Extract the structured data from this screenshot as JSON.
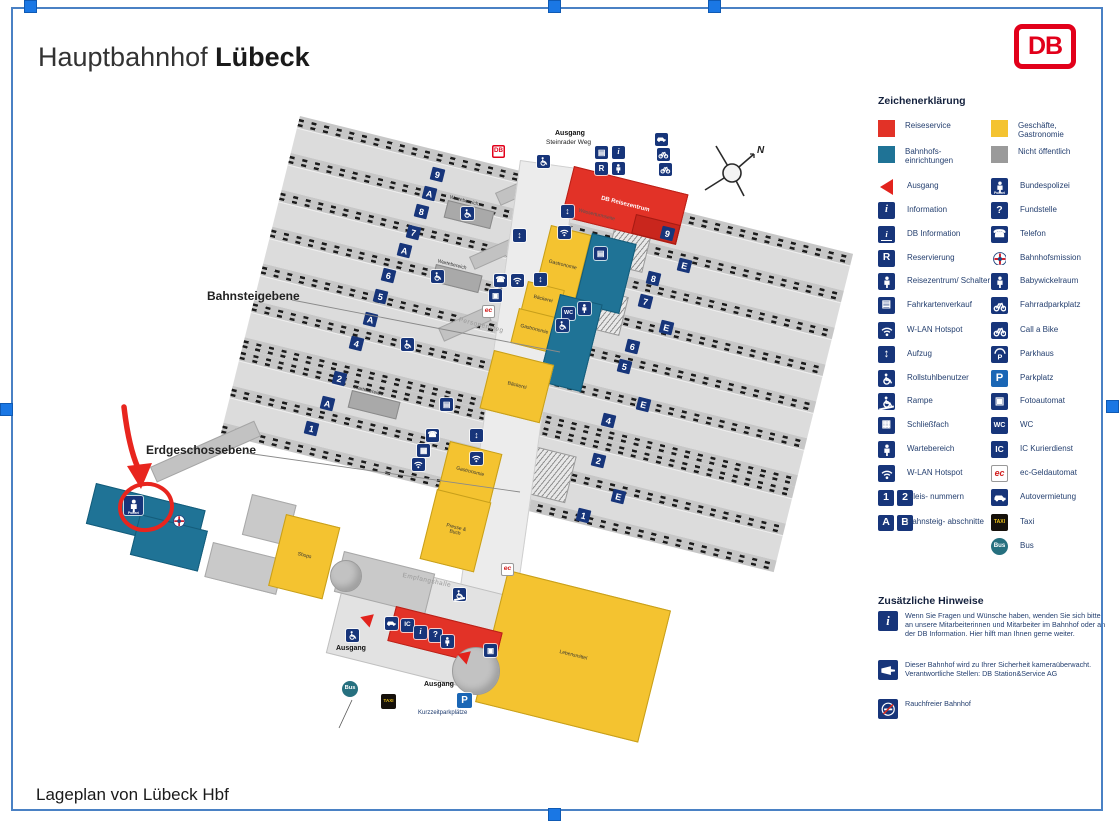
{
  "header": {
    "title_regular": "Hauptbahnhof",
    "title_bold": "Lübeck",
    "logo_text": "DB"
  },
  "footer": {
    "caption": "Lageplan von Lübeck Hbf"
  },
  "colors": {
    "reiseservice_red": "#e23227",
    "shops_yellow": "#f4c330",
    "einrichtungen_teal": "#1f7396",
    "nicht_oeffentlich_gray": "#9a9a9a",
    "picto_navy": "#17357a",
    "frame_blue": "#4a81c4",
    "handle_blue": "#1a77e4",
    "db_red": "#e2001a",
    "annotation_red": "#e8251e"
  },
  "legend": {
    "title": "Zeichenerklärung",
    "swatches": [
      {
        "name": "reiseservice",
        "color": "#e23227",
        "label": "Reiseservice"
      },
      {
        "name": "geschaefte-gastronomie",
        "color": "#f4c330",
        "label": "Geschäfte, Gastronomie"
      },
      {
        "name": "bahnhofseinrichtungen",
        "color": "#1f7396",
        "label": "Bahnhofs- einrichtungen"
      },
      {
        "name": "nicht-oeffentlich",
        "color": "#9a9a9a",
        "label": "Nicht öffentlich"
      }
    ],
    "rows": [
      {
        "left": {
          "icon": "ausgang",
          "label": "Ausgang"
        },
        "right": {
          "icon": "bundespolizei",
          "label": "Bundespolizei"
        }
      },
      {
        "left": {
          "icon": "information",
          "label": "Information"
        },
        "right": {
          "icon": "fundstelle",
          "label": "Fundstelle"
        }
      },
      {
        "left": {
          "icon": "db-information",
          "label": "DB Information"
        },
        "right": {
          "icon": "telefon",
          "label": "Telefon"
        }
      },
      {
        "left": {
          "icon": "reservierung",
          "label": "Reservierung"
        },
        "right": {
          "icon": "bahnhofsmission",
          "label": "Bahnhofsmission"
        }
      },
      {
        "left": {
          "icon": "schalter",
          "label": "Reisezentrum/ Schalter"
        },
        "right": {
          "icon": "babywickelraum",
          "label": "Babywickelraum"
        }
      },
      {
        "left": {
          "icon": "fahrkartenverkauf",
          "label": "Fahrkartenverkauf"
        },
        "right": {
          "icon": "fahrradparkplatz",
          "label": "Fahrradparkplatz"
        }
      },
      {
        "left": {
          "icon": "wlan",
          "label": "W-LAN Hotspot"
        },
        "right": {
          "icon": "call-a-bike",
          "label": "Call a Bike"
        }
      },
      {
        "left": {
          "icon": "aufzug",
          "label": "Aufzug"
        },
        "right": {
          "icon": "parkhaus",
          "label": "Parkhaus"
        }
      },
      {
        "left": {
          "icon": "rollstuhl",
          "label": "Rollstuhlbenutzer"
        },
        "right": {
          "icon": "parkplatz",
          "label": "Parkplatz"
        }
      },
      {
        "left": {
          "icon": "rampe",
          "label": "Rampe"
        },
        "right": {
          "icon": "fotoautomat",
          "label": "Fotoautomat"
        }
      },
      {
        "left": {
          "icon": "schliessfach",
          "label": "Schließfach"
        },
        "right": {
          "icon": "wc",
          "label": "WC"
        }
      },
      {
        "left": {
          "icon": "wartebereich",
          "label": "Wartebereich"
        },
        "right": {
          "icon": "ic",
          "label": "IC Kurierdienst"
        }
      },
      {
        "left": {
          "icon": "wlan",
          "label": "W-LAN Hotspot"
        },
        "right": {
          "icon": "ec",
          "label": "ec-Geldautomat"
        }
      },
      {
        "left": {
          "icon": "gleis-1-2",
          "label": "Gleis- nummern"
        },
        "right": {
          "icon": "autovermietung",
          "label": "Autovermietung"
        }
      },
      {
        "left": {
          "icon": "abschnitt-a-b",
          "label": "Bahnsteig- abschnitte"
        },
        "right": {
          "icon": "taxi",
          "label": "Taxi"
        }
      },
      {
        "left": null,
        "right": {
          "icon": "bus",
          "label": "Bus"
        }
      }
    ]
  },
  "notes": {
    "title": "Zusätzliche Hinweise",
    "items": [
      {
        "icon": "information",
        "text": "Wenn Sie Fragen und Wünsche haben, wenden Sie sich bitte an unsere Mitarbeiterinnen und Mitarbeiter im Bahnhof oder an der DB Information. Hier hilft man Ihnen gerne weiter."
      },
      {
        "icon": "kamera",
        "text": "Dieser Bahnhof wird zu Ihrer Sicherheit kameraüberwacht. Verantwortliche Stellen: DB Station&Service AG"
      },
      {
        "icon": "rauchfrei",
        "text": "Rauchfreier Bahnhof"
      }
    ]
  },
  "map": {
    "compass_label": "N",
    "shelter_label": "Wartebereich",
    "buildings": {
      "db_reisezentrum": "DB Reisezentrum",
      "gastronomie_top": "Gastronomie",
      "baeckerei_mid": "Bäckerei",
      "gastronomie_mid": "Gastronomie",
      "baeckerei_big": "Bäckerei",
      "gastronomie_low": "Gastronomie",
      "presse_buch": "Presse & Buch",
      "shops": "Shops",
      "lebensmittel": "Lebensmittel"
    },
    "texts": [
      {
        "id": "exit-top-line1",
        "t": "Ausgang",
        "x": 555,
        "y": 130,
        "k": "bold"
      },
      {
        "id": "exit-top-line2",
        "t": "Steinrader Weg",
        "x": 546,
        "y": 139,
        "k": "small"
      },
      {
        "id": "bridge-label",
        "t": "Wasserturmseite",
        "x": 578,
        "y": 212,
        "k": "tiny",
        "r": 14
      },
      {
        "id": "walkway-label",
        "t": "Personensteg",
        "x": 458,
        "y": 322,
        "k": "gray",
        "r": 14
      },
      {
        "id": "hall-label",
        "t": "Empfangshalle",
        "x": 402,
        "y": 577,
        "k": "gray",
        "r": 12
      },
      {
        "id": "exit-left-label",
        "t": "Ausgang",
        "x": 336,
        "y": 645,
        "k": "bold"
      },
      {
        "id": "exit-bottom-label",
        "t": "Ausgang",
        "x": 424,
        "y": 681,
        "k": "bold"
      },
      {
        "id": "parking-label",
        "t": "Kurzzeitparkplätze",
        "x": 418,
        "y": 710,
        "k": "navy"
      },
      {
        "id": "level-platform-label",
        "t": "Bahnsteigebene",
        "x": 207,
        "y": 289,
        "k": "level"
      },
      {
        "id": "level-ground-label",
        "t": "Erdgeschossebene",
        "x": 146,
        "y": 443,
        "k": "level"
      }
    ],
    "platform_badges": [
      {
        "t": "9",
        "x": 431,
        "y": 168
      },
      {
        "t": "A",
        "x": 423,
        "y": 187
      },
      {
        "t": "8",
        "x": 415,
        "y": 205
      },
      {
        "t": "7",
        "x": 407,
        "y": 226
      },
      {
        "t": "A",
        "x": 398,
        "y": 244
      },
      {
        "t": "6",
        "x": 382,
        "y": 269
      },
      {
        "t": "5",
        "x": 374,
        "y": 290
      },
      {
        "t": "A",
        "x": 364,
        "y": 313
      },
      {
        "t": "4",
        "x": 350,
        "y": 337
      },
      {
        "t": "2",
        "x": 333,
        "y": 372
      },
      {
        "t": "A",
        "x": 321,
        "y": 397
      },
      {
        "t": "1",
        "x": 305,
        "y": 422
      },
      {
        "t": "9",
        "x": 661,
        "y": 227
      },
      {
        "t": "E",
        "x": 678,
        "y": 259
      },
      {
        "t": "8",
        "x": 647,
        "y": 272
      },
      {
        "t": "7",
        "x": 639,
        "y": 295
      },
      {
        "t": "E",
        "x": 660,
        "y": 321
      },
      {
        "t": "6",
        "x": 626,
        "y": 340
      },
      {
        "t": "5",
        "x": 618,
        "y": 360
      },
      {
        "t": "E",
        "x": 637,
        "y": 398
      },
      {
        "t": "4",
        "x": 602,
        "y": 414
      },
      {
        "t": "2",
        "x": 592,
        "y": 454
      },
      {
        "t": "E",
        "x": 612,
        "y": 490
      },
      {
        "t": "1",
        "x": 577,
        "y": 509
      }
    ],
    "icons": [
      {
        "t": "autovermietung",
        "x": 655,
        "y": 133
      },
      {
        "t": "fahrradparkplatz",
        "x": 657,
        "y": 148
      },
      {
        "t": "call-a-bike",
        "x": 659,
        "y": 163
      },
      {
        "t": "fahrkartenverkauf",
        "x": 595,
        "y": 146
      },
      {
        "t": "information",
        "x": 612,
        "y": 146
      },
      {
        "t": "reservierung",
        "x": 595,
        "y": 162
      },
      {
        "t": "schalter",
        "x": 612,
        "y": 162
      },
      {
        "t": "rollstuhl",
        "x": 537,
        "y": 155
      },
      {
        "t": "db-mini",
        "x": 492,
        "y": 145
      },
      {
        "t": "aufzug",
        "x": 561,
        "y": 205
      },
      {
        "t": "wlan",
        "x": 558,
        "y": 226
      },
      {
        "t": "kiosk",
        "x": 594,
        "y": 247
      },
      {
        "t": "aufzug",
        "x": 534,
        "y": 273
      },
      {
        "t": "telefon",
        "x": 494,
        "y": 274
      },
      {
        "t": "wlan",
        "x": 511,
        "y": 274
      },
      {
        "t": "fotoautomat",
        "x": 489,
        "y": 289
      },
      {
        "t": "ec",
        "x": 482,
        "y": 305
      },
      {
        "t": "wc",
        "x": 562,
        "y": 307
      },
      {
        "t": "babywickelraum",
        "x": 578,
        "y": 302
      },
      {
        "t": "rollstuhl",
        "x": 556,
        "y": 319
      },
      {
        "t": "rollstuhl",
        "x": 461,
        "y": 207
      },
      {
        "t": "rollstuhl",
        "x": 431,
        "y": 270
      },
      {
        "t": "rollstuhl",
        "x": 401,
        "y": 338
      },
      {
        "t": "aufzug",
        "x": 513,
        "y": 229
      },
      {
        "t": "telefon",
        "x": 426,
        "y": 429
      },
      {
        "t": "schliessfach",
        "x": 417,
        "y": 444
      },
      {
        "t": "wlan",
        "x": 412,
        "y": 458
      },
      {
        "t": "aufzug",
        "x": 470,
        "y": 429
      },
      {
        "t": "wlan",
        "x": 470,
        "y": 452
      },
      {
        "t": "fahrkartenverkauf",
        "x": 440,
        "y": 398
      },
      {
        "t": "rampe",
        "x": 453,
        "y": 588
      },
      {
        "t": "ec",
        "x": 501,
        "y": 563
      },
      {
        "t": "autovermietung",
        "x": 385,
        "y": 617
      },
      {
        "t": "ic",
        "x": 401,
        "y": 619
      },
      {
        "t": "information",
        "x": 414,
        "y": 626
      },
      {
        "t": "fundstelle",
        "x": 429,
        "y": 629
      },
      {
        "t": "wartebereich",
        "x": 441,
        "y": 635
      },
      {
        "t": "rollstuhl",
        "x": 346,
        "y": 629
      },
      {
        "t": "fotoautomat",
        "x": 484,
        "y": 644
      },
      {
        "t": "parkplatz",
        "x": 457,
        "y": 693,
        "s": 15
      },
      {
        "t": "taxi",
        "x": 381,
        "y": 694,
        "s": 15
      },
      {
        "t": "bus",
        "x": 342,
        "y": 681,
        "s": 16
      },
      {
        "t": "bundespolizei",
        "x": 124,
        "y": 496,
        "s": 19
      },
      {
        "t": "bahnhofsmission",
        "x": 172,
        "y": 514,
        "s": 15
      }
    ]
  }
}
